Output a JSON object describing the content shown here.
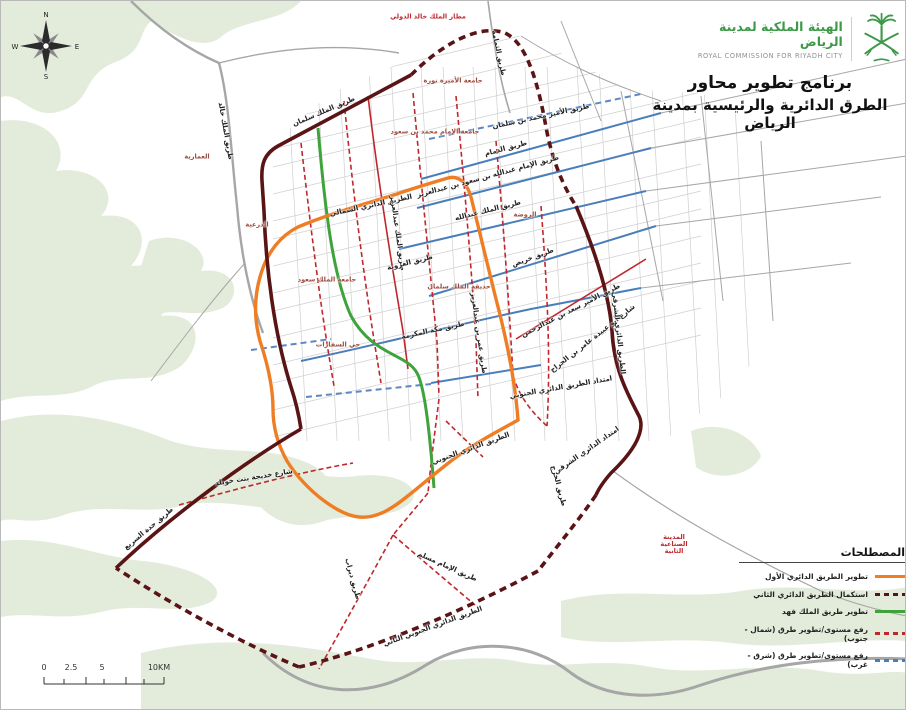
{
  "header": {
    "org_ar": "الهيئة الملكية لمدينة الرياض",
    "org_en": "ROYAL COMMISSION FOR RIYADH CITY",
    "brand_green": "#3d9948"
  },
  "title": {
    "line1": "برنامج تطوير محاور",
    "line2": "الطرق الدائرية والرئيسية بمدينة الرياض"
  },
  "legend": {
    "title": "المصطلحات",
    "items": [
      {
        "label": "تطوير الطريق الدائري الأول",
        "style": "orange-solid",
        "color": "#ee7d23"
      },
      {
        "label": "استكمال الطريق الدائري الثاني",
        "style": "maroon-dashed",
        "color": "#5a1416"
      },
      {
        "label": "تطوير طريق الملك فهد",
        "style": "green-solid",
        "color": "#3fa33c"
      },
      {
        "label": "رفع مستوى/تطوير طرق (شمال - جنوب)",
        "style": "red-dashed",
        "color": "#c0272d"
      },
      {
        "label": "رفع مستوى/تطوير طرق (شرق - غرب)",
        "style": "blue-dashed",
        "color": "#4a7ebb"
      }
    ]
  },
  "compass": {
    "n": "N",
    "e": "E",
    "s": "S",
    "w": "W"
  },
  "scalebar": {
    "ticks": [
      "0",
      "2.5",
      "5",
      "10KM"
    ]
  },
  "map": {
    "labels": [
      {
        "t": "مطار الملك خالد الدولي",
        "x": 427,
        "y": 16,
        "r": 0,
        "c": "c-red"
      },
      {
        "t": "طريق الثمامة",
        "x": 497,
        "y": 52,
        "r": 78,
        "c": ""
      },
      {
        "t": "جامعة الأميرة نورة",
        "x": 452,
        "y": 80,
        "r": 0,
        "c": "c-district"
      },
      {
        "t": "طريق الملك سلمان",
        "x": 323,
        "y": 111,
        "r": -23,
        "c": ""
      },
      {
        "t": "طريق الملك خالد",
        "x": 224,
        "y": 130,
        "r": 80,
        "c": ""
      },
      {
        "t": "العمارية",
        "x": 196,
        "y": 156,
        "r": 0,
        "c": "c-district"
      },
      {
        "t": "الدرعية",
        "x": 256,
        "y": 224,
        "r": 0,
        "c": "c-district"
      },
      {
        "t": "جامعة الإمام محمد بن سعود",
        "x": 434,
        "y": 131,
        "r": 0,
        "c": "c-district"
      },
      {
        "t": "طريق الدمام",
        "x": 505,
        "y": 148,
        "r": -15,
        "c": ""
      },
      {
        "t": "طريق الإمام عبدالله بن سعود بن عبدالعزيز",
        "x": 487,
        "y": 176,
        "r": -15,
        "c": ""
      },
      {
        "t": "طريق الملك عبدالله",
        "x": 487,
        "y": 210,
        "r": -14,
        "c": ""
      },
      {
        "t": "الروضة",
        "x": 524,
        "y": 214,
        "r": 0,
        "c": "c-district"
      },
      {
        "t": "الطريق الدائري الشمالي",
        "x": 370,
        "y": 205,
        "r": -12,
        "c": ""
      },
      {
        "t": "طريق الملك عبدالعزيز",
        "x": 396,
        "y": 232,
        "r": 82,
        "c": ""
      },
      {
        "t": "طريق الأمير محمد بن سلمان",
        "x": 540,
        "y": 116,
        "r": -12,
        "c": ""
      },
      {
        "t": "طريق العروبة",
        "x": 409,
        "y": 262,
        "r": -14,
        "c": ""
      },
      {
        "t": "حديقة الملك سلمان",
        "x": 458,
        "y": 286,
        "r": 0,
        "c": "c-district"
      },
      {
        "t": "طريق مكة المكرمة",
        "x": 432,
        "y": 330,
        "r": -12,
        "c": ""
      },
      {
        "t": "طريق خريص",
        "x": 532,
        "y": 257,
        "r": -20,
        "c": ""
      },
      {
        "t": "طريق عمر بن عبدالعزيز",
        "x": 477,
        "y": 332,
        "r": 82,
        "c": ""
      },
      {
        "t": "طريق الأمير سعد بن عبدالرحمن",
        "x": 570,
        "y": 310,
        "r": -27,
        "c": ""
      },
      {
        "t": "شارع أبو عبيدة عامر بن الجراح",
        "x": 592,
        "y": 338,
        "r": -38,
        "c": ""
      },
      {
        "t": "الطريق الدائري الشرقي",
        "x": 617,
        "y": 332,
        "r": 84,
        "c": ""
      },
      {
        "t": "امتداد الطريق الدائري الجنوبي",
        "x": 560,
        "y": 387,
        "r": -10,
        "c": ""
      },
      {
        "t": "طريق الخرج",
        "x": 557,
        "y": 485,
        "r": 75,
        "c": ""
      },
      {
        "t": "امتداد الدائري الشرقي",
        "x": 586,
        "y": 450,
        "r": -35,
        "c": ""
      },
      {
        "t": "المدينة الصناعية الثانية",
        "x": 673,
        "y": 543,
        "r": 0,
        "c": "c-red c-wrap"
      },
      {
        "t": "الطريق الدائري الجنوبي",
        "x": 470,
        "y": 448,
        "r": -20,
        "c": ""
      },
      {
        "t": "طريق جدة السريع",
        "x": 148,
        "y": 528,
        "r": -40,
        "c": ""
      },
      {
        "t": "شارع خديجة بنت خويلد",
        "x": 253,
        "y": 477,
        "r": -9,
        "c": ""
      },
      {
        "t": "طريق ديراب",
        "x": 351,
        "y": 578,
        "r": 75,
        "c": ""
      },
      {
        "t": "طريق الإمام مسلم",
        "x": 446,
        "y": 566,
        "r": 24,
        "c": ""
      },
      {
        "t": "الطريق الدائري الجنوبي الثاني",
        "x": 432,
        "y": 626,
        "r": -20,
        "c": ""
      },
      {
        "t": "جامعة الملك سعود",
        "x": 326,
        "y": 279,
        "r": 0,
        "c": "c-district"
      },
      {
        "t": "حي السفارات",
        "x": 337,
        "y": 344,
        "r": 0,
        "c": "c-district"
      }
    ],
    "colors": {
      "ring1_orange": "#ee7d23",
      "ring2_maroon": "#5a1416",
      "king_fahd_green": "#3fa33c",
      "upgrade_ns_red": "#c0272d",
      "upgrade_ew_blue": "#4a7ebb",
      "terrain_green": "#e3ecda"
    }
  }
}
